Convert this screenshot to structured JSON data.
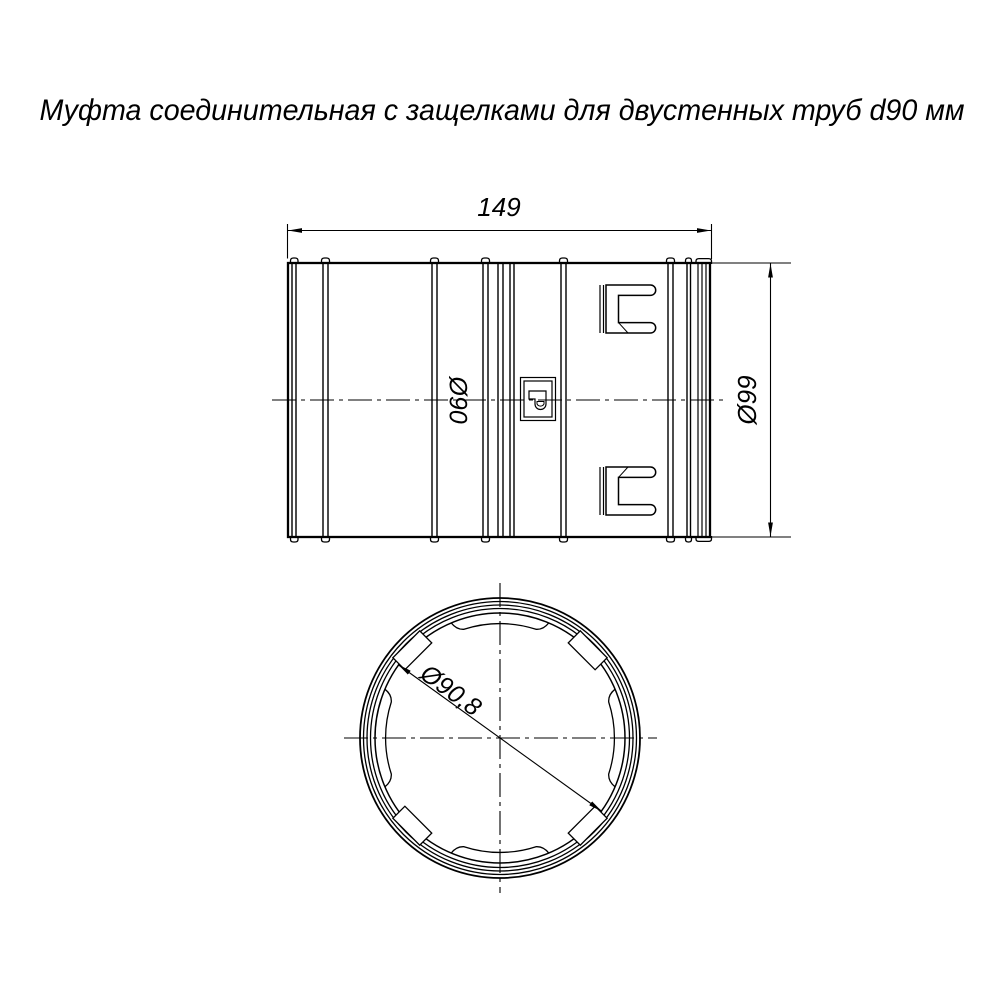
{
  "title": "Муфта соединительная с защелками для двустенных труб d90 мм",
  "colors": {
    "line": "#000000",
    "background": "#ffffff",
    "text": "#000000"
  },
  "side_view": {
    "length_dim": "149",
    "inner_diameter_label": "Ø90",
    "outer_diameter_dim": "Ø99"
  },
  "end_view": {
    "diameter_dim": "Ø90,8"
  }
}
